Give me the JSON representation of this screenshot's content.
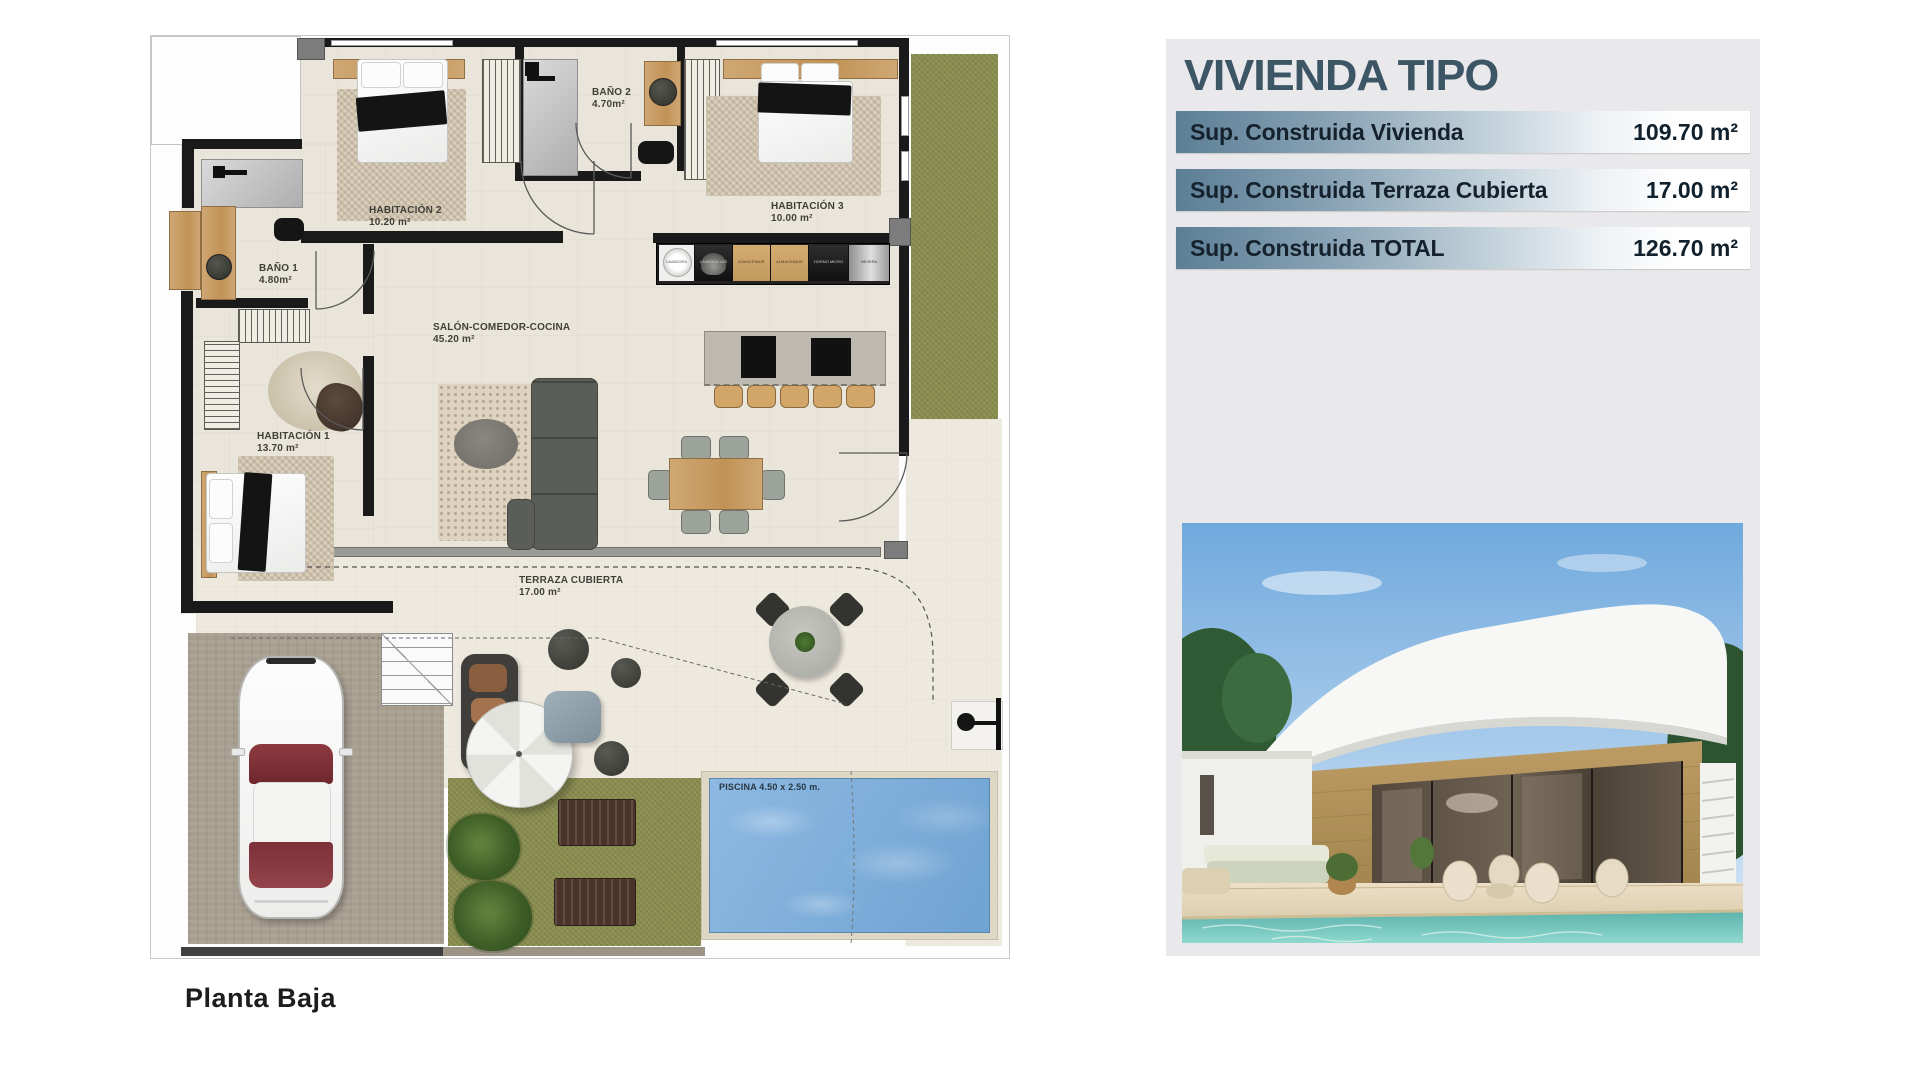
{
  "panel": {
    "title": "VIVIENDA TIPO",
    "rows": [
      {
        "label": "Sup. Construida Vivienda",
        "value": "109.70 m²"
      },
      {
        "label": "Sup. Construida Terraza Cubierta",
        "value": "17.00 m²"
      },
      {
        "label": "Sup. Construida TOTAL",
        "value": "126.70 m²"
      }
    ],
    "colors": {
      "title": "#3d5666",
      "row_text": "#12202c",
      "row_gradient_start": "#5c7e95",
      "panel_bg": "#e9e9eb"
    }
  },
  "floorplan": {
    "caption": "Planta Baja",
    "rooms": [
      {
        "name": "HABITACIÓN 2",
        "area": "10.20 m²"
      },
      {
        "name": "BAÑO 2",
        "area": "4.70m²"
      },
      {
        "name": "HABITACIÓN 3",
        "area": "10.00 m²"
      },
      {
        "name": "BAÑO 1",
        "area": "4.80m²"
      },
      {
        "name": "SALÓN-COMEDOR-COCINA",
        "area": "45.20 m²"
      },
      {
        "name": "HABITACIÓN 1",
        "area": "13.70 m²"
      },
      {
        "name": "TERRAZA CUBIERTA",
        "area": "17.00 m²"
      }
    ],
    "pool_label": "PISCINA 4.50 x 2.50 m.",
    "kitchen_units": [
      "LAVADORA",
      "LAVAVAJILLAS",
      "ALMACENAJE",
      "ALMACENAJE",
      "HORNO MICRO",
      "NEVERA"
    ],
    "colors": {
      "grass": "#8a8e4f",
      "pool_water": "#7fb0dc",
      "walls": "#1a1a1a",
      "floor": "#eae5da",
      "driveway": "#a89e90",
      "wood": "#c9a26b"
    }
  }
}
